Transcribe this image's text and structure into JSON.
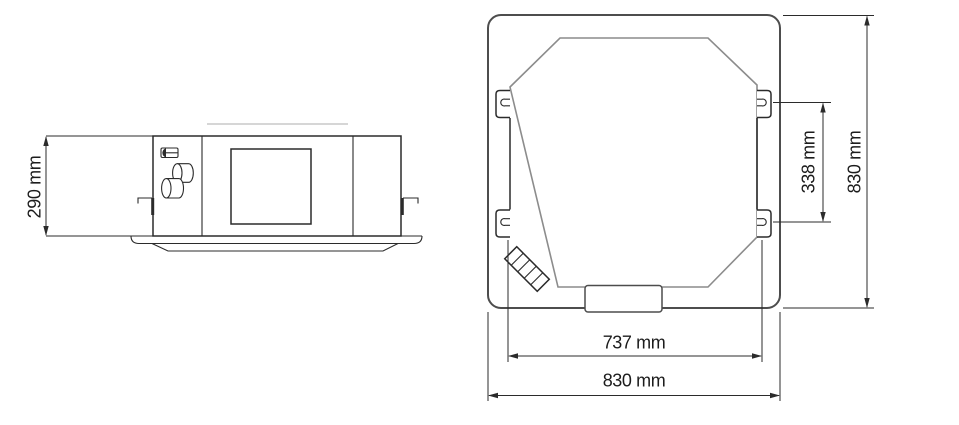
{
  "drawing": {
    "units": "mm",
    "views": {
      "side": {
        "height_label": "290 mm",
        "height_mm": 290
      },
      "plan": {
        "hanger_pitch_label": "338 mm",
        "hanger_pitch_mm": 338,
        "panel_height_label": "830 mm",
        "panel_height_mm": 830,
        "body_width_label": "737 mm",
        "body_width_mm": 737,
        "panel_width_label": "830 mm",
        "panel_width_mm": 830
      }
    },
    "colors": {
      "line_dark": "#2b2b2b",
      "line_medium": "#4d4d4d",
      "line_gray": "#8c8c8c",
      "line_faint": "#c8c8c8",
      "text": "#1c1c1c",
      "background": "#ffffff"
    }
  }
}
